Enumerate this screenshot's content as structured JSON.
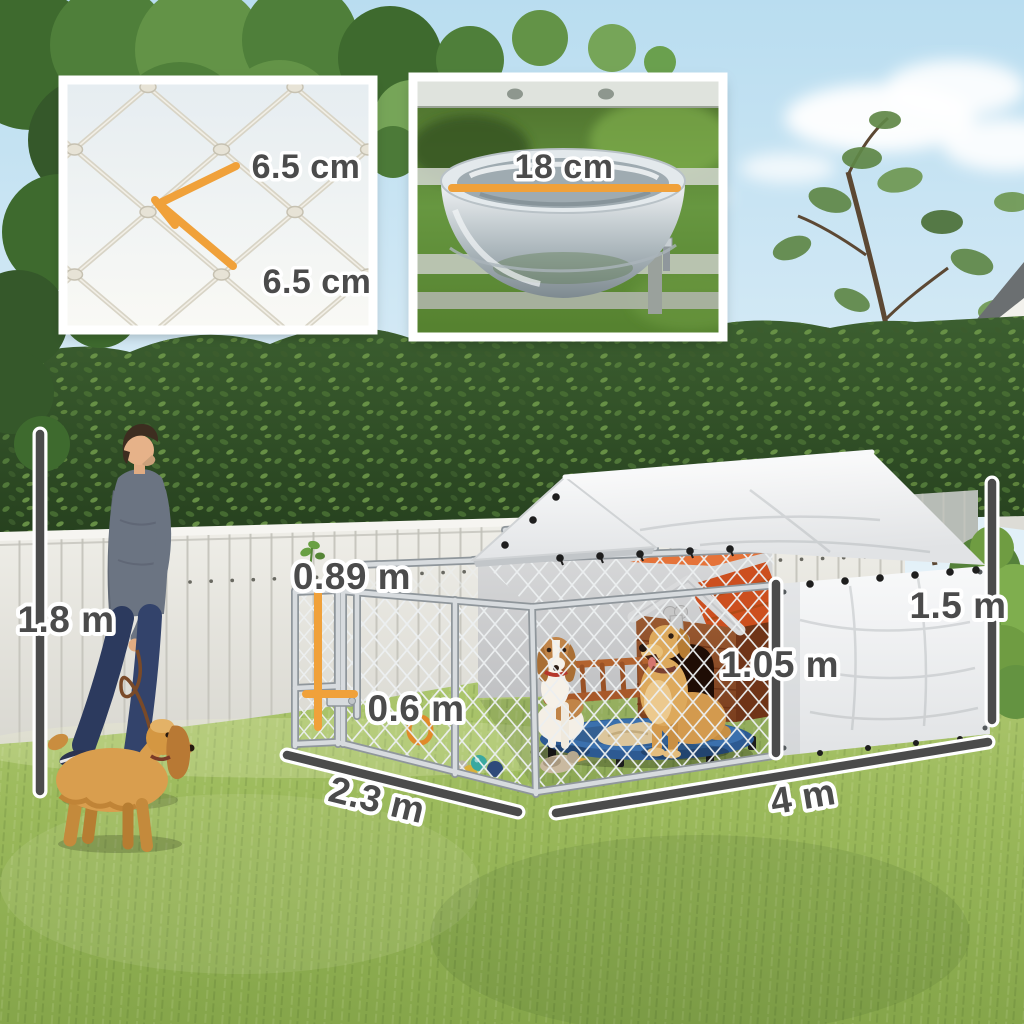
{
  "dimension_labels": {
    "person_height": "1.8 m",
    "gate_height": "0.89 m",
    "gate_width": "0.6 m",
    "run_depth": "2.3 m",
    "run_width": "4 m",
    "wall_height": "1.05 m",
    "roof_height": "1.5 m"
  },
  "inset_labels": {
    "mesh_opening_width": "6.5 cm",
    "mesh_opening_height": "6.5 cm",
    "bowl_diameter": "18 cm"
  },
  "colors": {
    "measure_line": "#4b4b4b",
    "measure_accent": "#f0a13a",
    "label_text": "#4b4b4b",
    "label_outline": "#ffffff"
  }
}
